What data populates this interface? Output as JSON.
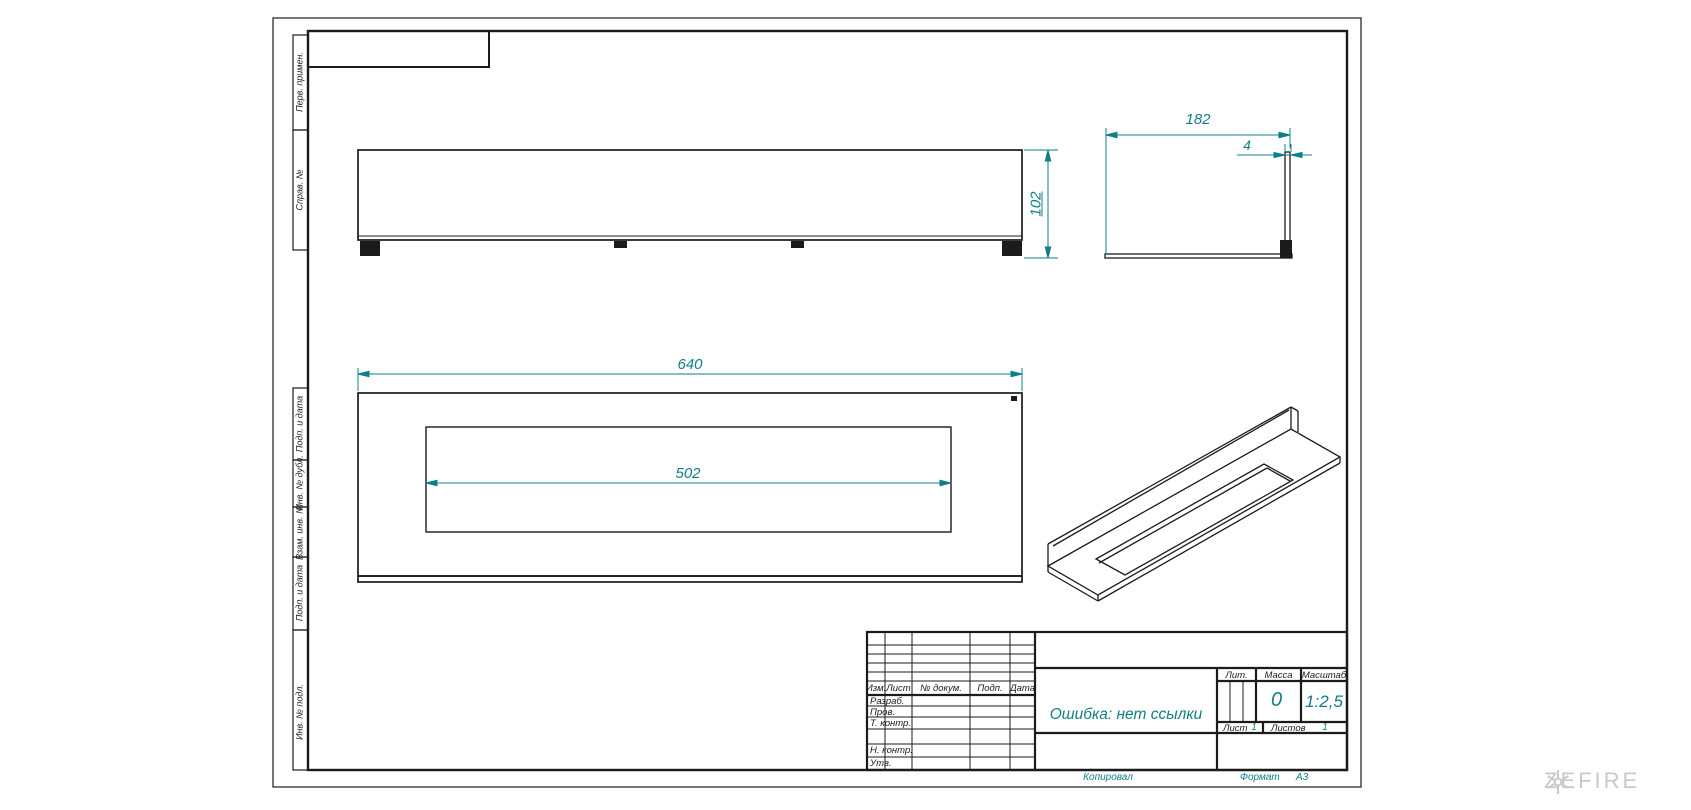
{
  "colors": {
    "dim_teal": "#0f7f86",
    "line_black": "#1b1b1b",
    "watermark_gray": "#c9c9c9"
  },
  "dimensions": {
    "overall_width": "640",
    "opening_width": "502",
    "depth": "182",
    "wall_thickness": "4",
    "height": "102"
  },
  "margin_labels": [
    "Перв. примен.",
    "Справ. №",
    "Подп. и дата",
    "Инв. № дубл.",
    "Взам. инв. №",
    "Подп. и дата",
    "Инв. № подл."
  ],
  "title_block": {
    "col_izm": "Изм.",
    "col_list": "Лист",
    "col_doc": "№ докум.",
    "col_podp": "Подп.",
    "col_data": "Дата",
    "row_razrab": "Разраб.",
    "row_prov": "Пров.",
    "row_tkontr": "Т. контр.",
    "row_nkontr": "Н. контр.",
    "row_utv": "Утв.",
    "doc_title": "Ошибка: нет ссылки",
    "lit_label": "Лит.",
    "mass_label": "Масса",
    "scale_label": "Масштаб",
    "mass_value": "0",
    "scale_value": "1:2,5",
    "list_label": "Лист",
    "list_value": "1",
    "listov_label": "Листов",
    "listov_value": "1",
    "copied": "Копировал",
    "format_label": "Формат",
    "format_value": "А3"
  },
  "watermark": {
    "brand": "ZEFIRE"
  }
}
